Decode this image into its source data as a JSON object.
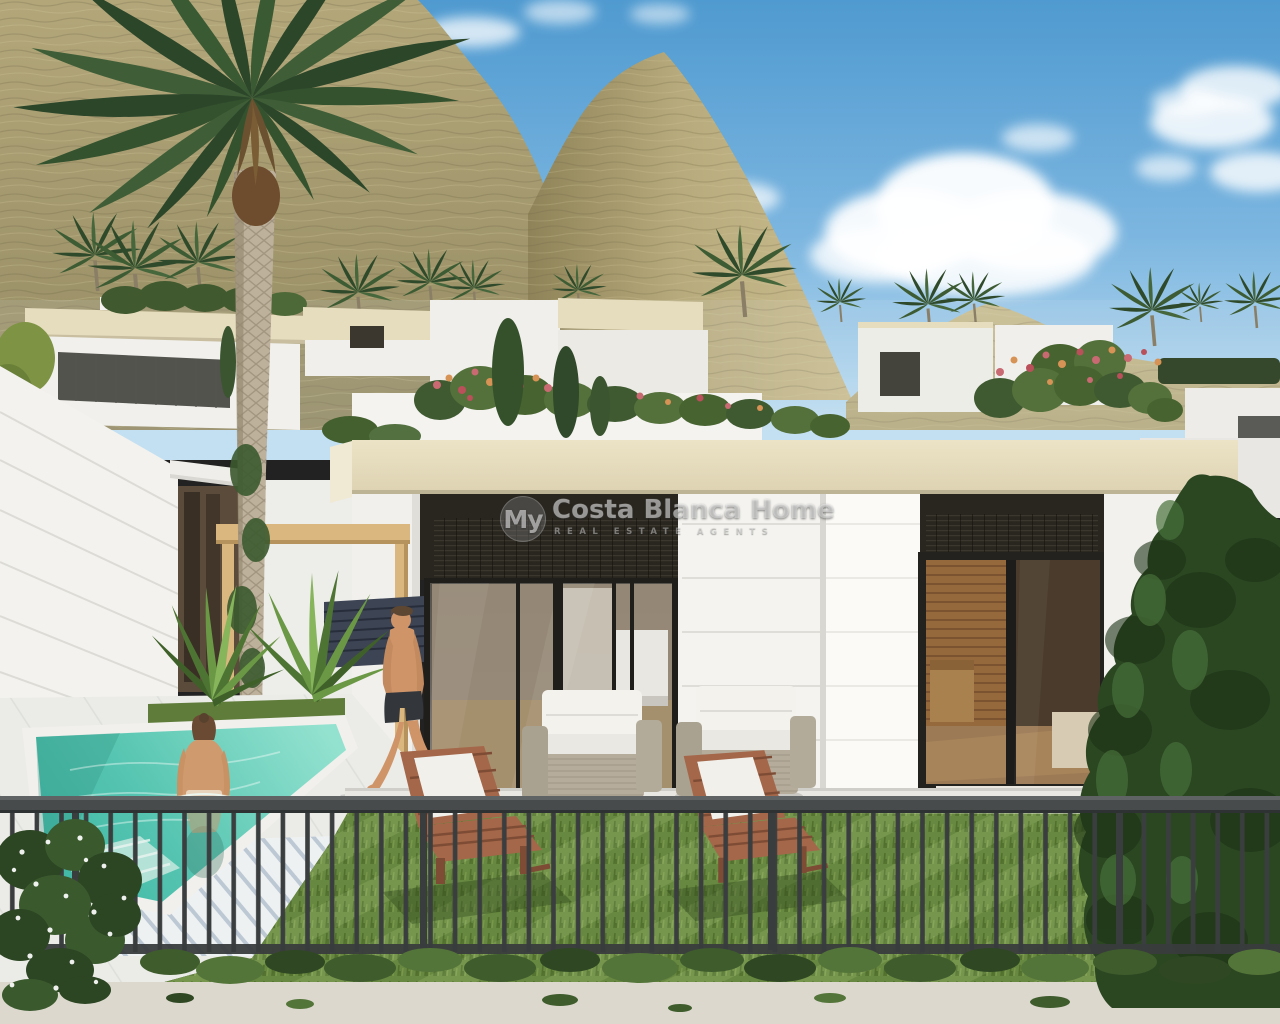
{
  "watermark": {
    "brand_short": "My",
    "brand_rest": "Costa Blanca Home",
    "tagline": "REAL ESTATE AGENTS"
  },
  "scene": {
    "description": "3D architectural rendering of modern white new-build villas on an arid hillside under a blue sky with clouds. A tall palm tree stands left of a flat-roofed villa with cream fascia, dark roller blinds and glass sliding doors. In front: a turquoise private plunge pool with a bather, a man walking on the white deck, spiky plants, a wooden pergola, two rattan armchairs, two wooden sun loungers on a lawn, a tall dark conifer on the right, and a black metal railing fence across the foreground."
  },
  "colors": {
    "sky-top": "#4f9ad0",
    "sky-low": "#c3e0f2",
    "cloud": "#ffffff",
    "mountain-light": "#cbbd8e",
    "mountain-mid": "#b0a478",
    "mountain-dark": "#8f8359",
    "palm-dark": "#2c462a",
    "palm-mid": "#3f5e37",
    "palm-light": "#567a45",
    "trunk": "#bdb19b",
    "roof-cream": "#e6ddbf",
    "wall-white": "#f4f3ef",
    "porch-dark": "#29261f",
    "interior-wood": "#96693c",
    "pool-turquoise": "#56c5b1",
    "deck-white": "#ebebe7",
    "grass-green": "#6d8f43",
    "fence-gray": "#3e4142",
    "conifer-green": "#2b4722",
    "deck-chair-wood": "#a4674a",
    "rattan-beige": "#b5ac9b",
    "cushion-white": "#f3f2ed",
    "pergola-wood": "#dab77e",
    "skin-tan": "#cf9468",
    "pavement": "#dcd8cd",
    "watermark-gray": "#d9d9d9"
  }
}
